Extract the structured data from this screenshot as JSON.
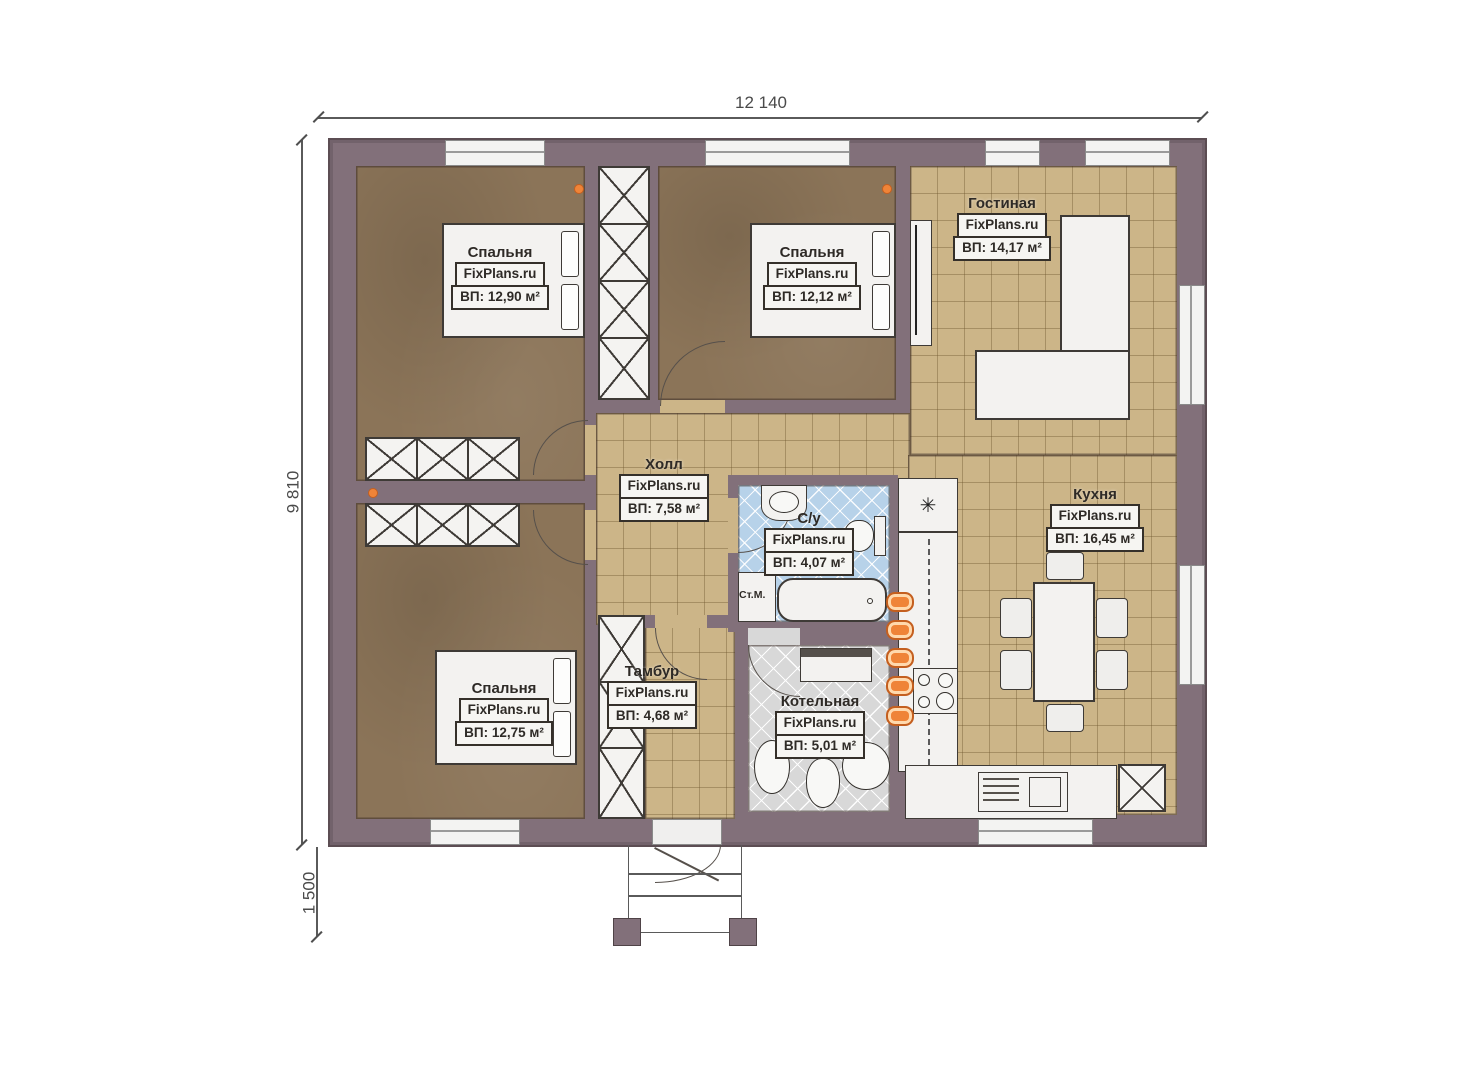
{
  "dimensions": {
    "width_top": "12 140",
    "height_left": "9 810",
    "porch_height": "1 500"
  },
  "brand": "FixPlans.ru",
  "rooms": [
    {
      "id": "bedroom-1",
      "name": "Спальня",
      "brand": "FixPlans.ru",
      "area": "ВП: 12,90 м²"
    },
    {
      "id": "bedroom-2",
      "name": "Спальня",
      "brand": "FixPlans.ru",
      "area": "ВП: 12,12 м²"
    },
    {
      "id": "living",
      "name": "Гостиная",
      "brand": "FixPlans.ru",
      "area": "ВП: 14,17 м²"
    },
    {
      "id": "hall",
      "name": "Холл",
      "brand": "FixPlans.ru",
      "area": "ВП: 7,58 м²"
    },
    {
      "id": "bathroom",
      "name": "С/у",
      "brand": "FixPlans.ru",
      "area": "ВП: 4,07 м²"
    },
    {
      "id": "kitchen",
      "name": "Кухня",
      "brand": "FixPlans.ru",
      "area": "ВП: 16,45 м²"
    },
    {
      "id": "bedroom-3",
      "name": "Спальня",
      "brand": "FixPlans.ru",
      "area": "ВП: 12,75 м²"
    },
    {
      "id": "vestibule",
      "name": "Тамбур",
      "brand": "FixPlans.ru",
      "area": "ВП: 4,68 м²"
    },
    {
      "id": "boiler",
      "name": "Котельная",
      "brand": "FixPlans.ru",
      "area": "ВП: 5,01 м²"
    }
  ],
  "annotations": {
    "washing_machine": "Ст.М."
  },
  "icons": {
    "fridge_snowflake": "✳"
  },
  "colors": {
    "wall": "#82707a",
    "wall_dark": "#5c4d53",
    "bedroom_floor": "#8b7458",
    "tile_floor": "#ccb588",
    "bath_tile": "#b7d2e9",
    "boiler_tile": "#d8d8d8",
    "radiator_orange": "#ef8438",
    "line": "#3c3c3c"
  }
}
